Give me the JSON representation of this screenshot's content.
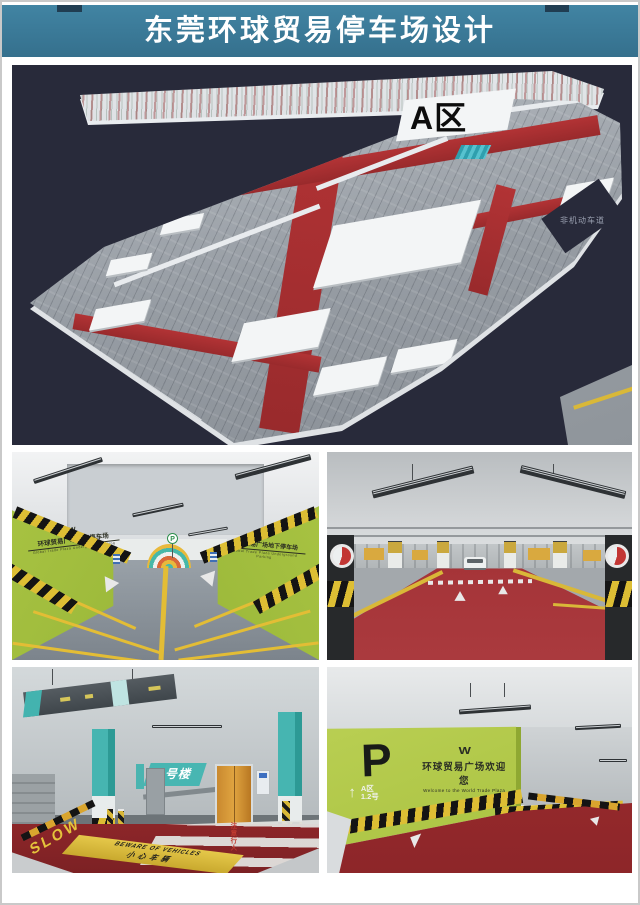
{
  "title": "东莞环球贸易停车场设计",
  "aerial": {
    "zone_label": "A区",
    "lane_note": "非机动车道"
  },
  "views": {
    "ramp": {
      "wall_sign": "环球贸易广场地下停车场",
      "wall_sign_en": "Global Trade Plaza Underground Parking",
      "p_sign": "P"
    },
    "building_entry": {
      "building_sign": "1号楼",
      "slow_marking": "SLOW",
      "pedestrian_note": "注意行人",
      "warning_en": "BEWARE OF VEHICLES",
      "warning_cn": "小心车辆"
    },
    "welcome_wall": {
      "p_logo": "P",
      "w_logo": "W",
      "welcome_cn": "环球贸易广场欢迎您",
      "welcome_en": "Welcome to the World Trade Plaza",
      "up_arrow": "↑",
      "zone": "A区",
      "building_no": "1.2号"
    }
  },
  "colors": {
    "header_teal": "#35708d",
    "background_navy": "#282a3a",
    "green_wall": "#a6bf3d",
    "red_floor": "#9a2a2d",
    "teal_accent": "#46b5b1",
    "warning_yellow": "#ddbe34"
  }
}
